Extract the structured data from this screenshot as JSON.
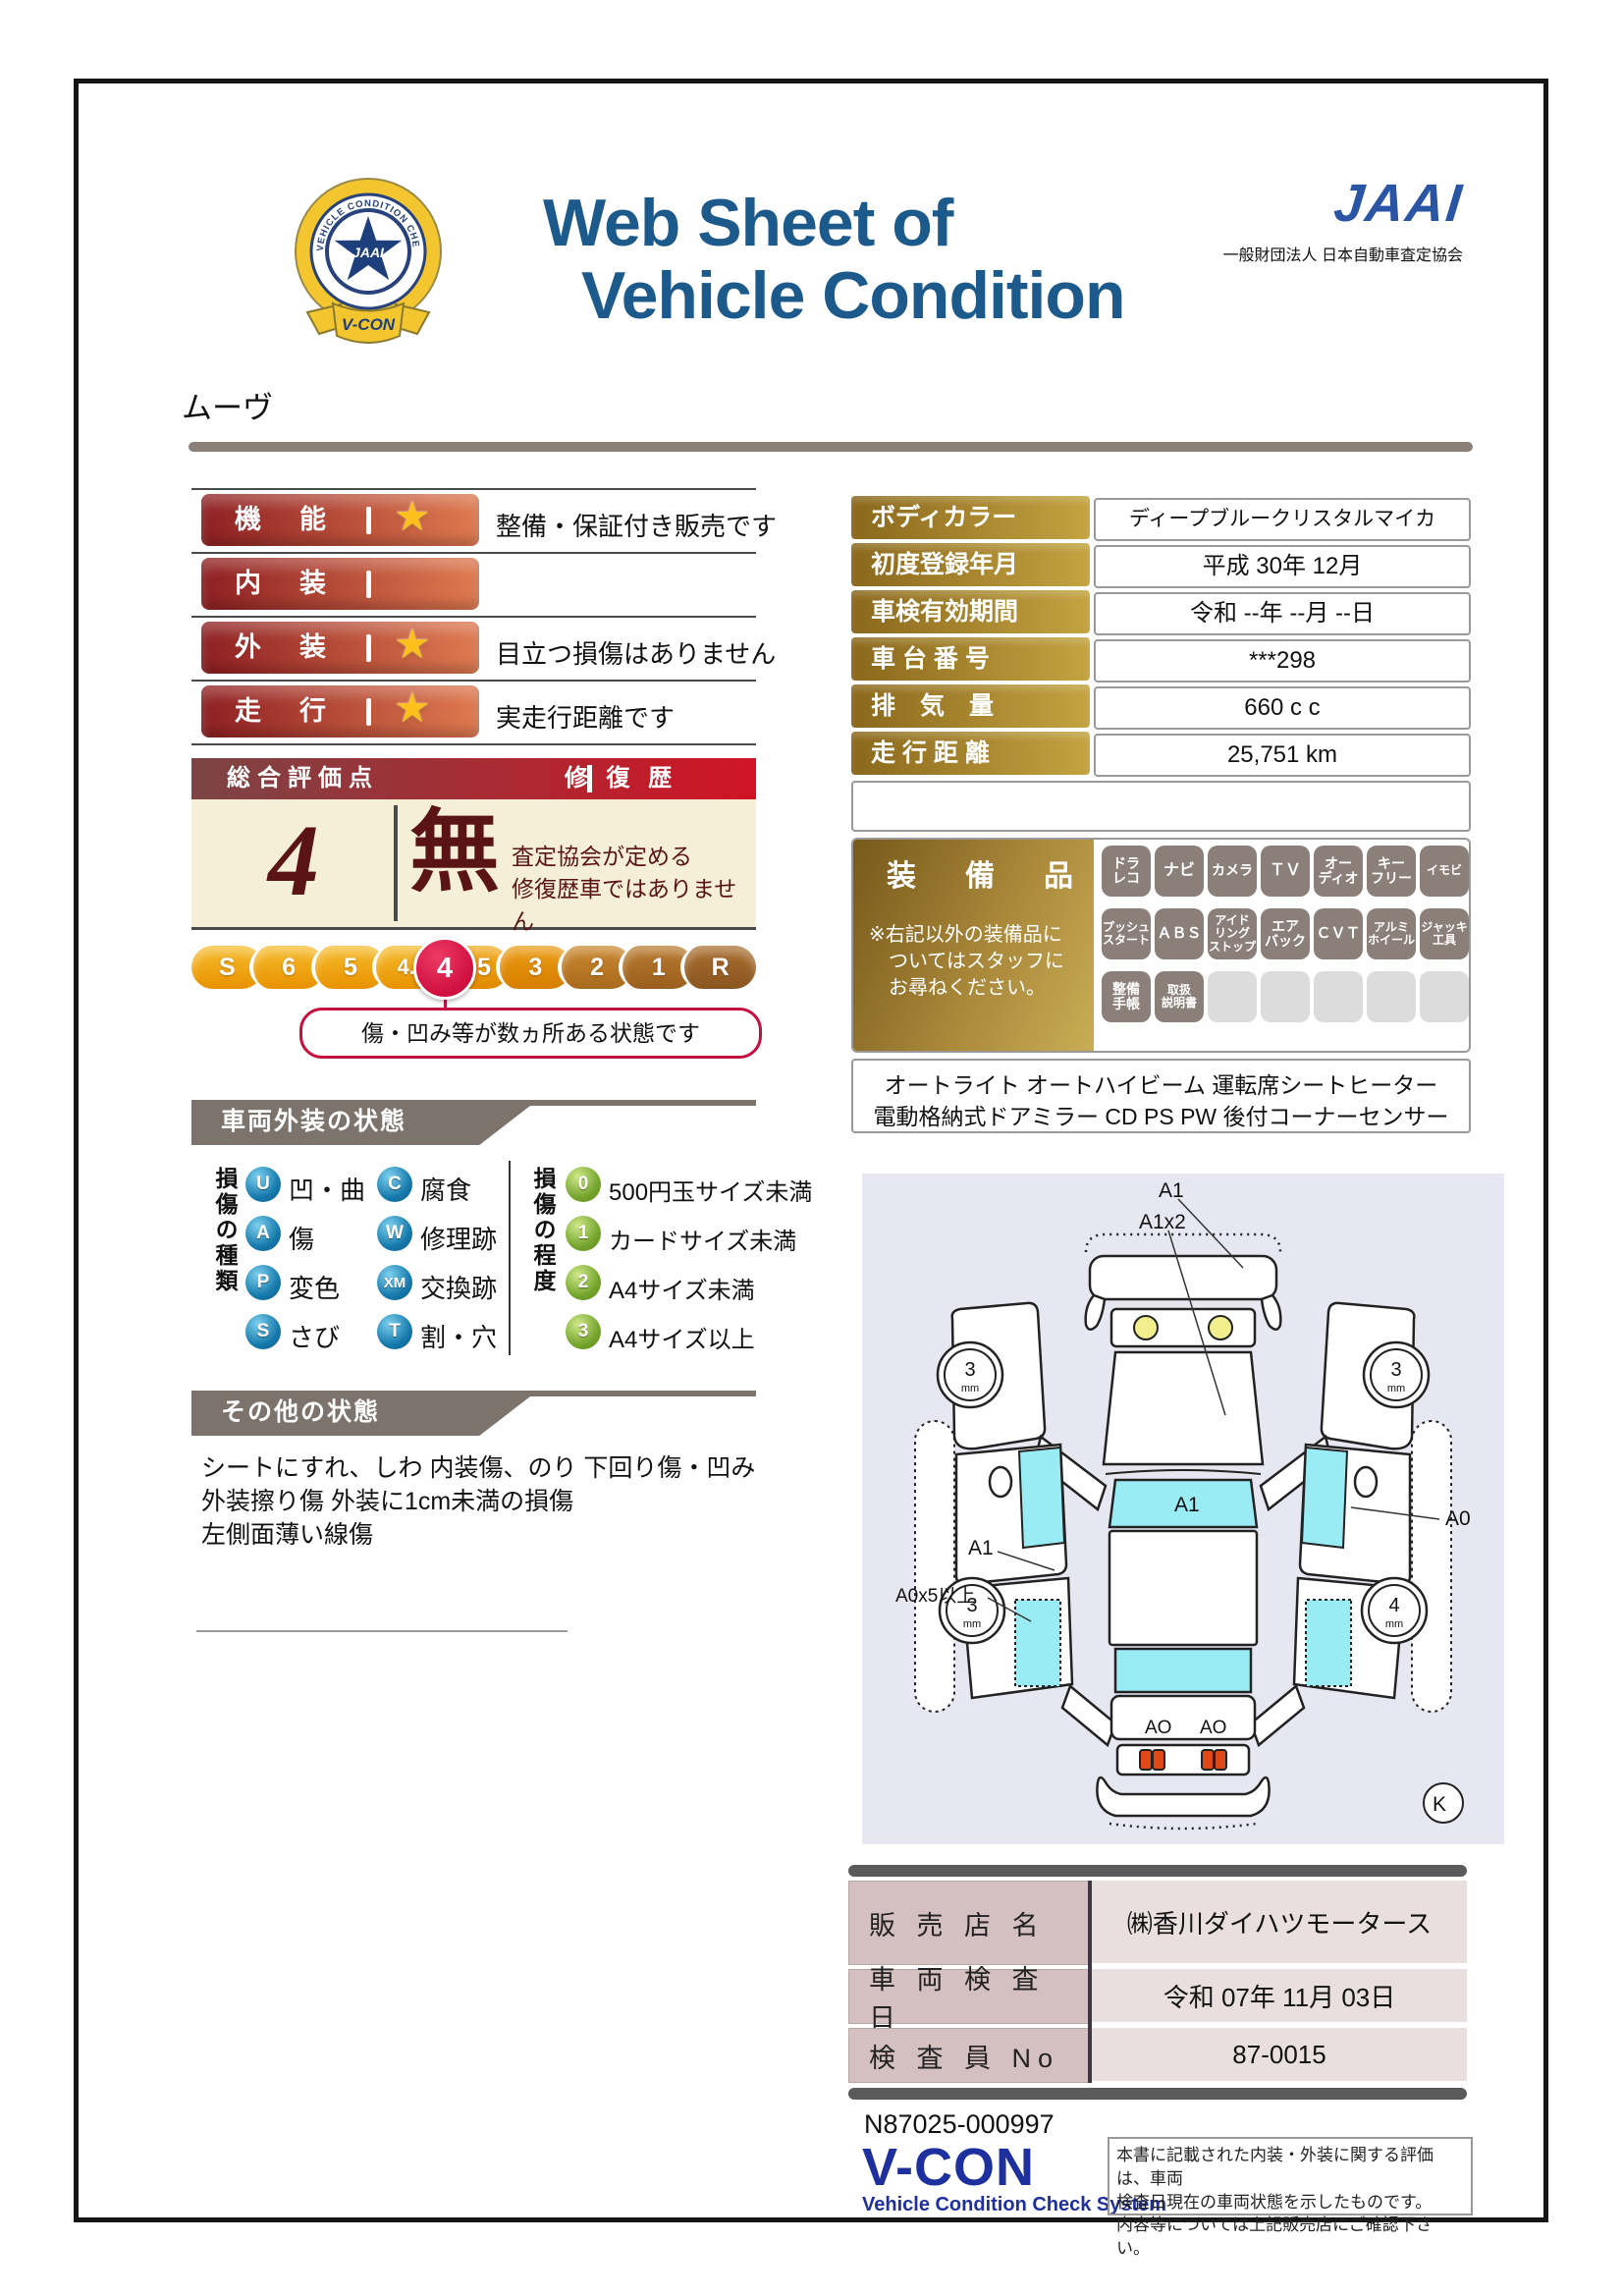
{
  "header": {
    "badge_ring_text": "VEHICLE CONDITION CHECK SYSTEM",
    "badge_center": "JAAI",
    "badge_ribbon": "V-CON",
    "title_line1": "Web Sheet of",
    "title_line2": "Vehicle Condition",
    "jaai_logo": "JAAI",
    "jaai_org": "一般財団法人 日本自動車査定協会",
    "title_color": "#1d5a8c"
  },
  "vehicle_name": "ムーヴ",
  "ratings": {
    "rows": [
      {
        "label": "機　能",
        "star": "★",
        "note": "整備・保証付き販売です"
      },
      {
        "label": "内　装",
        "star": "",
        "note": ""
      },
      {
        "label": "外　装",
        "star": "★",
        "note": "目立つ損傷はありません"
      },
      {
        "label": "走　行",
        "star": "★",
        "note": "実走行距離です"
      }
    ]
  },
  "overall": {
    "header_left": "総合評価点",
    "header_right": "修 復 歴",
    "score": "4",
    "repair": "無",
    "repair_note": "査定協会が定める\n修復歴車ではありません"
  },
  "scale": {
    "segments": [
      "S",
      "6",
      "5",
      "4.5",
      "3.5",
      "3",
      "2",
      "1",
      "R"
    ],
    "selected": "4",
    "bubble": "傷・凹み等が数ヵ所ある状態です",
    "selected_color": "#cf0f3f"
  },
  "info": {
    "rows": [
      {
        "label": "ボディカラー",
        "value": "ディープブルークリスタルマイカ"
      },
      {
        "label": "初度登録年月",
        "value": "平成 30年 12月"
      },
      {
        "label": "車検有効期間",
        "value": "令和 --年 --月 --日"
      },
      {
        "label": "車 台 番 号",
        "value": "***298"
      },
      {
        "label": "排　気　量",
        "value": "660 c c"
      },
      {
        "label": "走 行 距 離",
        "value": "25,751 km"
      }
    ]
  },
  "equipment": {
    "title": "装　備　品",
    "note": "※右記以外の装備品に\n　ついてはスタッフに\n　お尋ねください。",
    "badges": [
      {
        "label": "ドラ\nレコ"
      },
      {
        "label": "ナビ"
      },
      {
        "label": "カメラ"
      },
      {
        "label": "ＴＶ"
      },
      {
        "label": "オー\nディオ"
      },
      {
        "label": "キー\nフリー"
      },
      {
        "label": "イモビ"
      },
      {
        "label": "プッシュ\nスタート"
      },
      {
        "label": "ＡＢＳ"
      },
      {
        "label": "アイド\nリング\nストップ"
      },
      {
        "label": "エア\nバック"
      },
      {
        "label": "ＣＶＴ"
      },
      {
        "label": "アルミ\nホイール"
      },
      {
        "label": "ジャッキ\n工具"
      },
      {
        "label": "整備\n手帳"
      },
      {
        "label": "取扱\n説明書"
      },
      {
        "label": ""
      },
      {
        "label": ""
      },
      {
        "label": ""
      },
      {
        "label": ""
      },
      {
        "label": ""
      }
    ],
    "extra_line1": "オートライト オートハイビーム 運転席シートヒーター",
    "extra_line2": "電動格納式ドアミラー CD PS PW 後付コーナーセンサー"
  },
  "exterior": {
    "title": "車両外装の状態",
    "type_title": "損傷の種類",
    "types": [
      {
        "code": "U",
        "label": "凹・曲"
      },
      {
        "code": "A",
        "label": "傷"
      },
      {
        "code": "P",
        "label": "変色"
      },
      {
        "code": "S",
        "label": "さび"
      },
      {
        "code": "C",
        "label": "腐食"
      },
      {
        "code": "W",
        "label": "修理跡"
      },
      {
        "code": "XM",
        "label": "交換跡"
      },
      {
        "code": "T",
        "label": "割・穴"
      }
    ],
    "degree_title": "損傷の程度",
    "degrees": [
      {
        "code": "0",
        "label": "500円玉サイズ未満"
      },
      {
        "code": "1",
        "label": "カードサイズ未満"
      },
      {
        "code": "2",
        "label": "A4サイズ未満"
      },
      {
        "code": "3",
        "label": "A4サイズ以上"
      }
    ],
    "type_icon_color": "#1579ab",
    "degree_icon_color": "#74a42c"
  },
  "other": {
    "title": "その他の状態",
    "text": "シートにすれ、しわ 内装傷、のり 下回り傷・凹み\n外装擦り傷 外装に1cm未満の損傷\n左側面薄い線傷"
  },
  "diagram": {
    "label_top1": "A1",
    "label_top2": "A1x2",
    "windshield_label": "A1",
    "label_left1": "A1",
    "label_left2": "A0x5以上",
    "label_right": "A0",
    "rear_label1": "AO",
    "rear_label2": "AO",
    "wheel_front_left": "3",
    "wheel_front_right": "3",
    "wheel_rear_left": "3",
    "wheel_rear_right": "4",
    "wheel_unit": "mm",
    "key_label": "K",
    "glass_color": "#9aecf4"
  },
  "dealer": {
    "rows": [
      {
        "label": "販 売 店 名",
        "value": "㈱香川ダイハツモータース"
      },
      {
        "label": "車 両 検 査 日",
        "value": "令和 07年 11月 03日"
      },
      {
        "label": "検 査 員 No",
        "value": "87-0015"
      }
    ]
  },
  "footer": {
    "code": "N87025-000997",
    "vcon": "V-CON",
    "vcon_sub": "Vehicle Condition Check System",
    "note": "本書に記載された内装・外装に関する評価は、車両\n検査日現在の車両状態を示したものです。\n内容等については上記販売店にご確認下さい。"
  }
}
